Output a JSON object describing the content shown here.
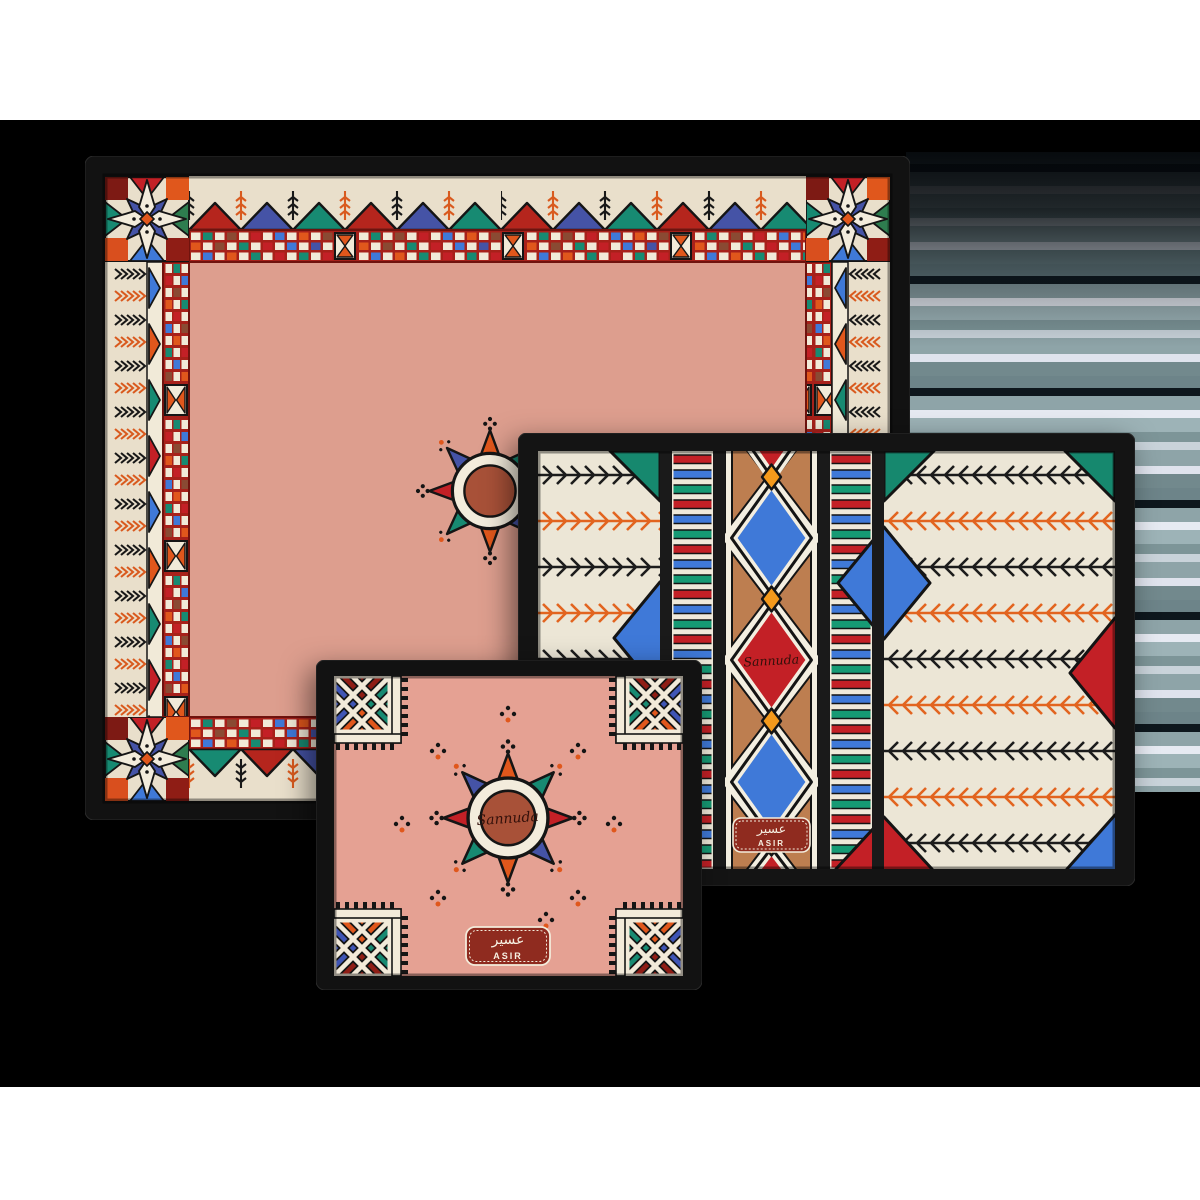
{
  "scene": {
    "subject": "Set of three black-framed decorative trays with Al-Qatt Al-Asiri geometric folk patterns",
    "background": {
      "top": "#ffffff",
      "middle_band": "#000000",
      "bottom": "#ffffff",
      "glitch_stripes": "gray-teal horizontal bands"
    }
  },
  "brand_script": "Sannuda",
  "asir_label": {
    "arabic": "عسير",
    "latin": "ASIR"
  },
  "trays": {
    "large": {
      "name": "large rectangular tray",
      "field_color": "#dd9e8e",
      "border": "cream with fern, zigzag-triangle and mosaic checker bands, eight-point star corners",
      "center": "sun-star medallion"
    },
    "medium": {
      "name": "medium rectangular tray",
      "field_color": "#ece6d6",
      "center_panel": "tan diamond lattice with blue and red diamonds",
      "columns": "fern branches, stripe bars, black dividers",
      "plaque": "ASIR"
    },
    "small": {
      "name": "small rectangular tray",
      "field_color": "#e5a193",
      "center": "sun-star medallion with signature",
      "corners": "x-cross squares with comb teeth",
      "plaque": "ASIR"
    }
  },
  "palette": {
    "frame": "#141414",
    "cream": "#ece4d0",
    "salmon": "#dd9e8e",
    "pink": "#e5a193",
    "red": "#c32026",
    "band_red": "#a7211a",
    "maroon": "#7d1a14",
    "orange": "#e0571c",
    "amber": "#f59a1b",
    "blue": "#3f79d8",
    "indigo": "#4553a6",
    "teal": "#178a72",
    "green": "#2e7d4f",
    "brown": "#8a4a33",
    "tan": "#bd7e50",
    "terracotta": "#a85138",
    "plaque_red": "#8f2b1f"
  },
  "motifs": {
    "large_center": "sun-star-medallion",
    "large_corners": "eight-point-star-block",
    "medium_center": "diamond-lattice",
    "small_corners": "x-cross-square",
    "borders": [
      "fern-branch",
      "zigzag-triangles",
      "mosaic-checker",
      "stripe-bars"
    ]
  }
}
